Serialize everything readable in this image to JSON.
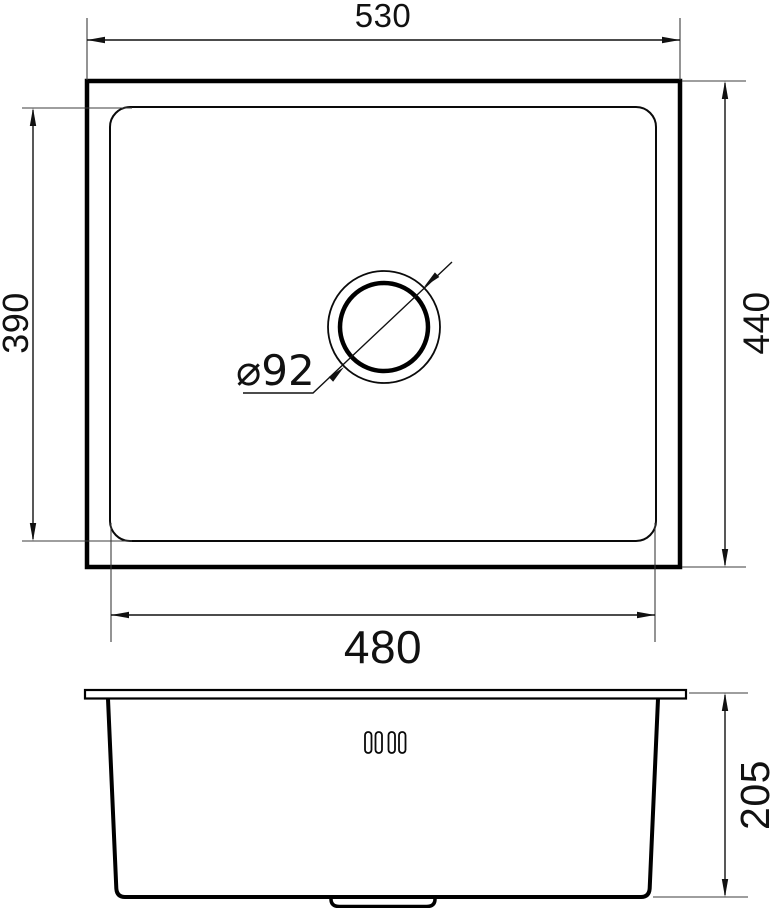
{
  "drawing": {
    "subject": "sink-technical-drawing",
    "background_color": "#ffffff",
    "line_color": "#000000",
    "views": {
      "top_view": {
        "dimensions": {
          "overall_width": "530",
          "overall_depth": "440",
          "basin_width": "480",
          "basin_depth": "390",
          "drain_diameter": "⌀92"
        }
      },
      "front_view": {
        "dimensions": {
          "overall_height": "205"
        }
      }
    }
  }
}
